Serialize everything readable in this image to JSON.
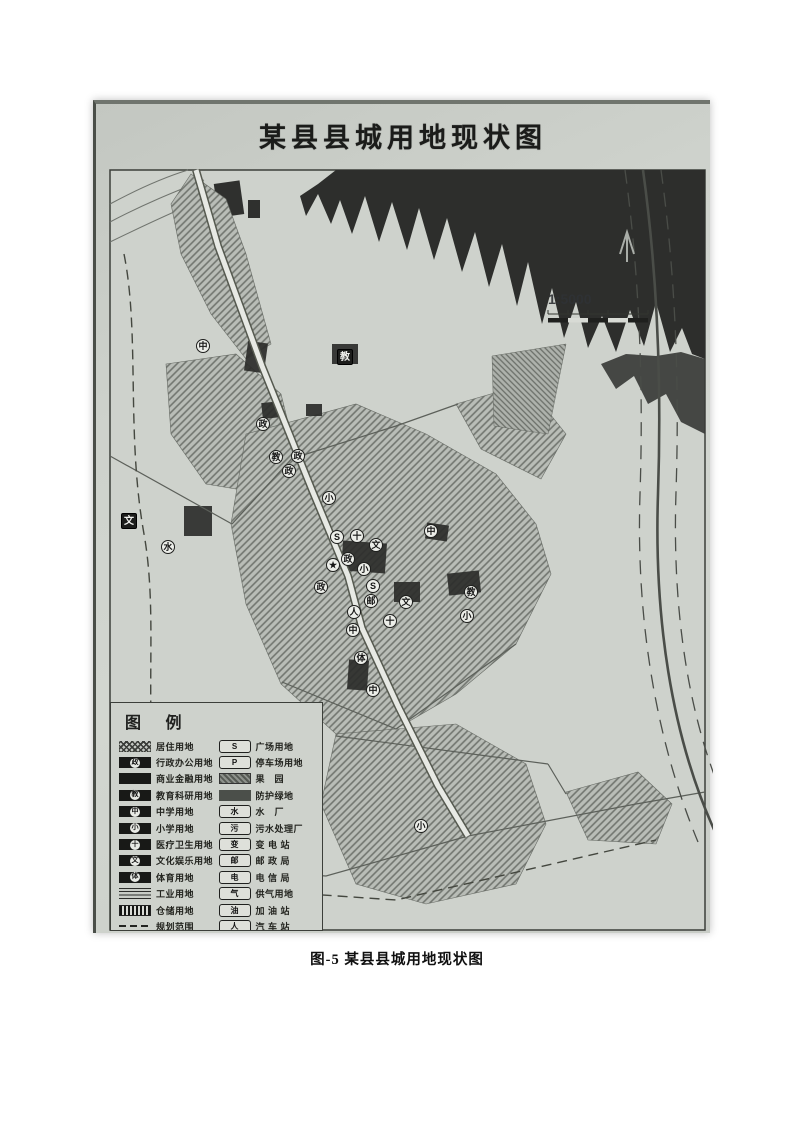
{
  "page": {
    "caption": "图-5  某县县城用地现状图"
  },
  "map": {
    "title": "某县县城用地现状图",
    "scale_text": "1:5000",
    "markers": [
      {
        "char": "中",
        "x": 107,
        "y": 242,
        "variant": "round"
      },
      {
        "char": "教",
        "x": 249,
        "y": 253,
        "variant": "dark"
      },
      {
        "char": "政",
        "x": 167,
        "y": 320,
        "variant": "round"
      },
      {
        "char": "教",
        "x": 180,
        "y": 353,
        "variant": "round"
      },
      {
        "char": "政",
        "x": 202,
        "y": 352,
        "variant": "round"
      },
      {
        "char": "政",
        "x": 193,
        "y": 367,
        "variant": "round"
      },
      {
        "char": "小",
        "x": 233,
        "y": 394,
        "variant": "round"
      },
      {
        "char": "文",
        "x": 33,
        "y": 417,
        "variant": "dark"
      },
      {
        "char": "水",
        "x": 72,
        "y": 443,
        "variant": "round"
      },
      {
        "char": "中",
        "x": 335,
        "y": 427,
        "variant": "round"
      },
      {
        "char": "S",
        "x": 241,
        "y": 433,
        "variant": "round"
      },
      {
        "char": "十",
        "x": 261,
        "y": 432,
        "variant": "round"
      },
      {
        "char": "文",
        "x": 280,
        "y": 441,
        "variant": "round"
      },
      {
        "char": "政",
        "x": 252,
        "y": 455,
        "variant": "round"
      },
      {
        "char": "★",
        "x": 237,
        "y": 461,
        "variant": "round"
      },
      {
        "char": "小",
        "x": 268,
        "y": 465,
        "variant": "round"
      },
      {
        "char": "政",
        "x": 225,
        "y": 483,
        "variant": "round"
      },
      {
        "char": "S",
        "x": 277,
        "y": 482,
        "variant": "round"
      },
      {
        "char": "邮",
        "x": 275,
        "y": 497,
        "variant": "round"
      },
      {
        "char": "文",
        "x": 310,
        "y": 498,
        "variant": "round"
      },
      {
        "char": "人",
        "x": 258,
        "y": 508,
        "variant": "round"
      },
      {
        "char": "教",
        "x": 375,
        "y": 488,
        "variant": "round"
      },
      {
        "char": "小",
        "x": 371,
        "y": 512,
        "variant": "round"
      },
      {
        "char": "十",
        "x": 294,
        "y": 517,
        "variant": "round"
      },
      {
        "char": "中",
        "x": 257,
        "y": 526,
        "variant": "round"
      },
      {
        "char": "体",
        "x": 265,
        "y": 554,
        "variant": "round"
      },
      {
        "char": "中",
        "x": 277,
        "y": 586,
        "variant": "round"
      },
      {
        "char": "小",
        "x": 325,
        "y": 722,
        "variant": "round"
      }
    ]
  },
  "legend": {
    "title": "图 例",
    "left": [
      {
        "swatch": "hatch-cross",
        "symbol": "",
        "label": "居住用地"
      },
      {
        "swatch": "black-badge",
        "symbol": "政",
        "label": "行政办公用地"
      },
      {
        "swatch": "solid-black",
        "symbol": "",
        "label": "商业金融用地"
      },
      {
        "swatch": "black-badge",
        "symbol": "教",
        "label": "教育科研用地"
      },
      {
        "swatch": "black-badge",
        "symbol": "中",
        "label": "中学用地"
      },
      {
        "swatch": "black-badge",
        "symbol": "小",
        "label": "小学用地"
      },
      {
        "swatch": "black-badge",
        "symbol": "十",
        "label": "医疗卫生用地"
      },
      {
        "swatch": "black-badge",
        "symbol": "文",
        "label": "文化娱乐用地"
      },
      {
        "swatch": "black-badge",
        "symbol": "体",
        "label": "体育用地"
      },
      {
        "swatch": "hatch-horiz",
        "symbol": "",
        "label": "工业用地"
      },
      {
        "swatch": "hatch-vert",
        "symbol": "",
        "label": "仓储用地"
      },
      {
        "swatch": "dash-line",
        "symbol": "",
        "label": "规划范围"
      }
    ],
    "right": [
      {
        "swatch": "white-box",
        "symbol": "S",
        "label": "广场用地"
      },
      {
        "swatch": "white-box",
        "symbol": "P",
        "label": "停车场用地"
      },
      {
        "swatch": "hatch-dense",
        "symbol": "",
        "label": "果　园"
      },
      {
        "swatch": "solid-gray",
        "symbol": "",
        "label": "防护绿地"
      },
      {
        "swatch": "white-box",
        "symbol": "水",
        "label": "水　厂"
      },
      {
        "swatch": "white-box",
        "symbol": "污",
        "label": "污水处理厂"
      },
      {
        "swatch": "white-box",
        "symbol": "变",
        "label": "变 电 站"
      },
      {
        "swatch": "white-box",
        "symbol": "邮",
        "label": "邮 政 局"
      },
      {
        "swatch": "white-box",
        "symbol": "电",
        "label": "电 信 局"
      },
      {
        "swatch": "white-box",
        "symbol": "气",
        "label": "供气用地"
      },
      {
        "swatch": "white-box",
        "symbol": "油",
        "label": "加 油 站"
      },
      {
        "swatch": "white-box",
        "symbol": "人",
        "label": "汽 车 站"
      }
    ]
  }
}
